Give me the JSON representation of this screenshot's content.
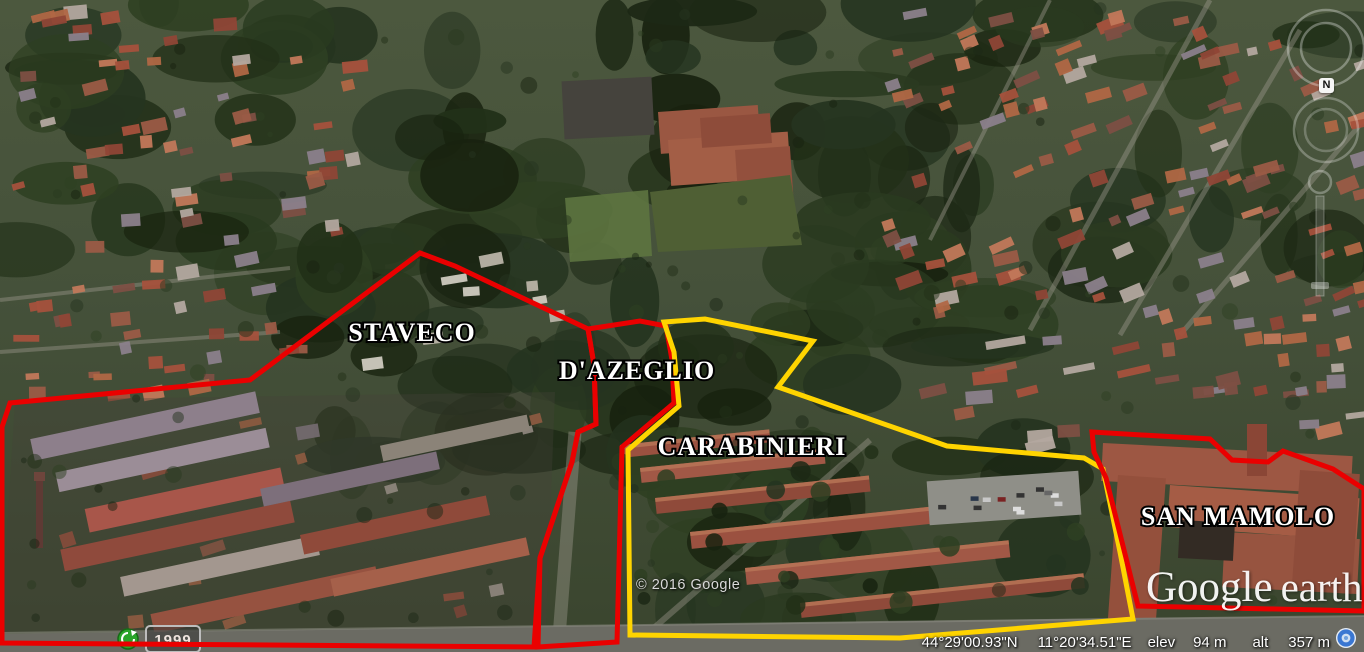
{
  "app": {
    "name": "Google Earth"
  },
  "watermark": {
    "google": "Google",
    "earth": "earth"
  },
  "copyright": "© 2016 Google",
  "status_bar": {
    "latitude": "44°29'00.93\"N",
    "longitude": "11°20'34.51\"E",
    "elev_label": "elev",
    "elevation": "94 m",
    "alt_label": "alt",
    "altitude": "357 m",
    "globe_icon_color": "#3a77d2"
  },
  "historical_imagery": {
    "year": "1999",
    "icon": "clock-icon",
    "icon_color": "#2aa52a"
  },
  "compass": {
    "north_label": "N"
  },
  "zones": [
    {
      "id": "staveco",
      "label": "STAVECO",
      "color": "#ea0000",
      "label_x": 412,
      "label_y": 341,
      "points": [
        [
          2,
          427
        ],
        [
          10,
          403
        ],
        [
          250,
          380
        ],
        [
          420,
          253
        ],
        [
          455,
          266
        ],
        [
          588,
          329
        ],
        [
          594,
          365
        ],
        [
          596,
          424
        ],
        [
          578,
          432
        ],
        [
          572,
          462
        ],
        [
          540,
          558
        ],
        [
          534,
          647
        ],
        [
          2,
          643
        ]
      ]
    },
    {
      "id": "dazeglio",
      "label": "D'AZEGLIO",
      "color": "#ea0000",
      "label_x": 637,
      "label_y": 379,
      "points": [
        [
          588,
          329
        ],
        [
          640,
          321
        ],
        [
          666,
          326
        ],
        [
          672,
          360
        ],
        [
          674,
          403
        ],
        [
          622,
          447
        ],
        [
          617,
          642
        ],
        [
          538,
          647
        ],
        [
          540,
          558
        ],
        [
          572,
          462
        ],
        [
          578,
          432
        ],
        [
          596,
          424
        ],
        [
          594,
          365
        ]
      ]
    },
    {
      "id": "carabinieri",
      "label": "CARABINIERI",
      "color": "#ffd400",
      "label_x": 752,
      "label_y": 455,
      "points": [
        [
          664,
          322
        ],
        [
          705,
          319
        ],
        [
          813,
          341
        ],
        [
          778,
          387
        ],
        [
          947,
          446
        ],
        [
          1084,
          458
        ],
        [
          1103,
          469
        ],
        [
          1120,
          552
        ],
        [
          1133,
          619
        ],
        [
          900,
          638
        ],
        [
          630,
          635
        ],
        [
          628,
          450
        ],
        [
          679,
          406
        ],
        [
          674,
          352
        ]
      ]
    },
    {
      "id": "san-mamolo",
      "label": "SAN MAMOLO",
      "color": "#ea0000",
      "label_x": 1238,
      "label_y": 525,
      "points": [
        [
          1092,
          432
        ],
        [
          1210,
          439
        ],
        [
          1232,
          460
        ],
        [
          1268,
          462
        ],
        [
          1283,
          451
        ],
        [
          1333,
          469
        ],
        [
          1364,
          489
        ],
        [
          1364,
          611
        ],
        [
          1138,
          606
        ],
        [
          1125,
          554
        ],
        [
          1106,
          478
        ],
        [
          1094,
          452
        ]
      ]
    }
  ]
}
